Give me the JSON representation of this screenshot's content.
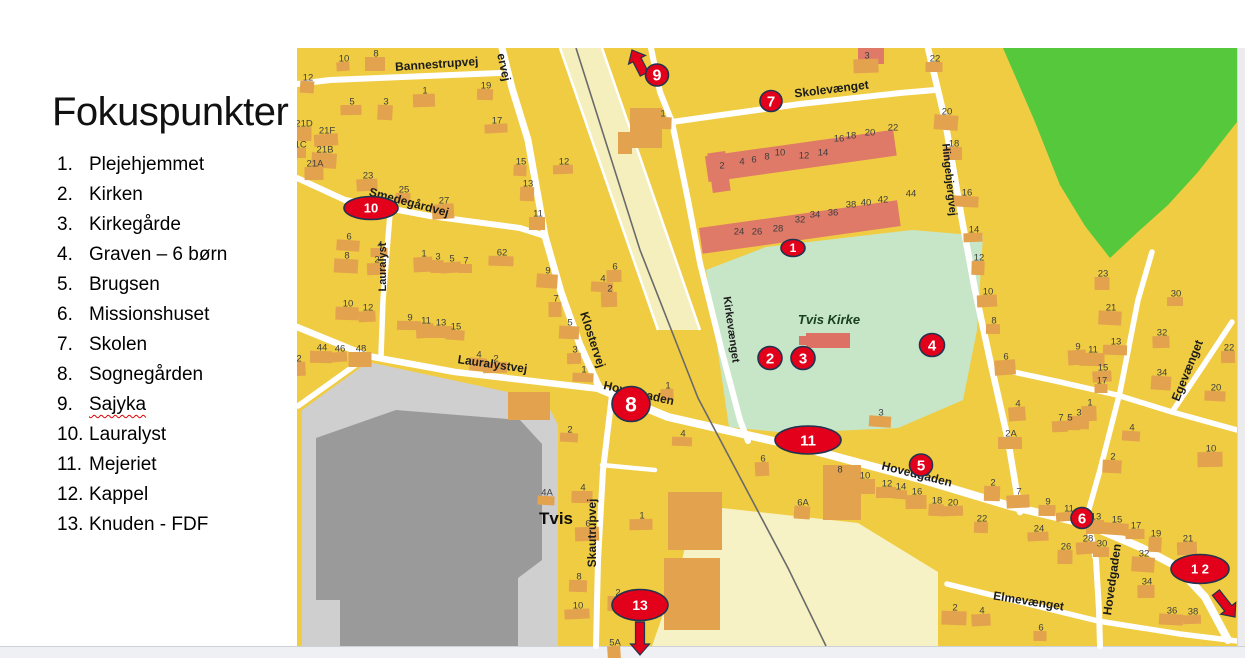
{
  "slide": {
    "title": "Fokuspunkter",
    "items": [
      {
        "num": "1.",
        "label": "Plejehjemmet"
      },
      {
        "num": "2.",
        "label": "Kirken"
      },
      {
        "num": "3.",
        "label": "Kirkegårde"
      },
      {
        "num": "4.",
        "label": "Graven – 6 børn"
      },
      {
        "num": "5.",
        "label": "Brugsen"
      },
      {
        "num": "6.",
        "label": "Missionshuset"
      },
      {
        "num": "7.",
        "label": "Skolen"
      },
      {
        "num": "8.",
        "label": "Sognegården"
      },
      {
        "num": "9.",
        "label": "Sajyka"
      },
      {
        "num": "10.",
        "label": "Lauralyst"
      },
      {
        "num": "11.",
        "label": "Mejeriet"
      },
      {
        "num": "12.",
        "label": "Kappel"
      },
      {
        "num": "13.",
        "label": "Knuden - FDF"
      }
    ]
  },
  "map": {
    "town_label": "Tvis",
    "church_label": "Tvis Kirke",
    "colors": {
      "base": "#F0CC42",
      "building": "#E3A24E",
      "rowhouse": "#DF7A68",
      "park": "#56C83C",
      "churchyard": "#C7E6C8",
      "road": "#ffffff",
      "rail_band": "#F5EFBE",
      "pale_district": "#F7F2C6",
      "factory_lot": "#CFCFCF",
      "factory": "#9A9A9A",
      "marker_fill": "#E2001A",
      "marker_stroke": "#1F3450"
    },
    "street_labels": [
      {
        "t": "Bannestrupvej",
        "x": 437,
        "y": 68,
        "r": -4,
        "s": 12,
        "style": "street"
      },
      {
        "t": "ervej",
        "x": 500,
        "y": 68,
        "r": 78,
        "s": 12,
        "style": "street"
      },
      {
        "t": "Smedegårdvej",
        "x": 408,
        "y": 206,
        "r": 15,
        "s": 12,
        "style": "street"
      },
      {
        "t": "Lauralyst",
        "x": 386,
        "y": 267,
        "r": -90,
        "s": 11,
        "style": "street"
      },
      {
        "t": "Lauralystvej",
        "x": 492,
        "y": 368,
        "r": 8,
        "s": 12,
        "style": "street"
      },
      {
        "t": "Klostervej",
        "x": 589,
        "y": 341,
        "r": 72,
        "s": 12,
        "style": "street"
      },
      {
        "t": "Hovedgaden",
        "x": 638,
        "y": 397,
        "r": 13,
        "s": 12,
        "style": "street"
      },
      {
        "t": "Skolevænget",
        "x": 832,
        "y": 93,
        "r": -7,
        "s": 12,
        "style": "street"
      },
      {
        "t": "Kirkevænget",
        "x": 728,
        "y": 330,
        "r": 82,
        "s": 11,
        "style": "street"
      },
      {
        "t": "Hingebjergvej",
        "x": 946,
        "y": 180,
        "r": 84,
        "s": 11,
        "style": "street"
      },
      {
        "t": "Egevænget",
        "x": 1191,
        "y": 372,
        "r": -68,
        "s": 12,
        "style": "street"
      },
      {
        "t": "Hovedgaden",
        "x": 916,
        "y": 478,
        "r": 14,
        "s": 12,
        "style": "street"
      },
      {
        "t": "Hovedgaden",
        "x": 1116,
        "y": 580,
        "r": -82,
        "s": 12,
        "style": "street"
      },
      {
        "t": "Skautrupvej",
        "x": 596,
        "y": 533,
        "r": -90,
        "s": 12,
        "style": "street"
      },
      {
        "t": "Elmevænget",
        "x": 1028,
        "y": 605,
        "r": 9,
        "s": 12,
        "style": "street"
      },
      {
        "t": "Tvis Kirke",
        "x": 829,
        "y": 324,
        "r": 0,
        "s": 13,
        "style": "church"
      },
      {
        "t": "Tvis",
        "x": 556,
        "y": 524,
        "r": 0,
        "s": 17,
        "style": "town"
      }
    ],
    "house_numbers": [
      [
        "10",
        344,
        58
      ],
      [
        "8",
        376,
        53
      ],
      [
        "12",
        308,
        77
      ],
      [
        "5",
        352,
        101
      ],
      [
        "3",
        386,
        101
      ],
      [
        "1",
        425,
        90
      ],
      [
        "19",
        486,
        85
      ],
      [
        "17",
        497,
        120
      ],
      [
        "21D",
        304,
        123
      ],
      [
        "21F",
        327,
        130
      ],
      [
        "21C",
        298,
        144
      ],
      [
        "21B",
        325,
        149
      ],
      [
        "21A",
        315,
        163
      ],
      [
        "15",
        521,
        161
      ],
      [
        "12",
        564,
        161
      ],
      [
        "13",
        528,
        183
      ],
      [
        "23",
        368,
        175
      ],
      [
        "25",
        404,
        189
      ],
      [
        "27",
        444,
        200
      ],
      [
        "11",
        538,
        213
      ],
      [
        "6",
        349,
        236
      ],
      [
        "4",
        380,
        244
      ],
      [
        "8",
        347,
        255
      ],
      [
        "2",
        377,
        259
      ],
      [
        "62",
        502,
        252
      ],
      [
        "1",
        424,
        253
      ],
      [
        "3",
        438,
        256
      ],
      [
        "5",
        452,
        258
      ],
      [
        "7",
        466,
        260
      ],
      [
        "9",
        548,
        270
      ],
      [
        "6",
        615,
        266
      ],
      [
        "4",
        603,
        278
      ],
      [
        "2",
        610,
        288
      ],
      [
        "10",
        348,
        303
      ],
      [
        "12",
        368,
        307
      ],
      [
        "9",
        410,
        317
      ],
      [
        "11",
        426,
        320
      ],
      [
        "13",
        441,
        322
      ],
      [
        "15",
        456,
        326
      ],
      [
        "7",
        556,
        298
      ],
      [
        "5",
        570,
        322
      ],
      [
        "3",
        575,
        349
      ],
      [
        "1",
        584,
        369
      ],
      [
        "2",
        299,
        358
      ],
      [
        "44",
        322,
        347
      ],
      [
        "46",
        340,
        348
      ],
      [
        "48",
        361,
        348
      ],
      [
        "4",
        479,
        354
      ],
      [
        "2",
        496,
        358
      ],
      [
        "2",
        570,
        429
      ],
      [
        "3",
        867,
        55
      ],
      [
        "1",
        663,
        113
      ],
      [
        "2",
        722,
        165,
        0
      ],
      [
        "4",
        742,
        161,
        0
      ],
      [
        "6",
        754,
        159,
        0
      ],
      [
        "8",
        767,
        156,
        0
      ],
      [
        "10",
        780,
        152,
        0
      ],
      [
        "12",
        804,
        155,
        0
      ],
      [
        "14",
        823,
        152,
        0
      ],
      [
        "16",
        839,
        138,
        0
      ],
      [
        "18",
        851,
        135,
        0
      ],
      [
        "20",
        870,
        132,
        0
      ],
      [
        "22",
        893,
        127,
        0
      ],
      [
        "24",
        739,
        231,
        0
      ],
      [
        "26",
        757,
        231,
        0
      ],
      [
        "28",
        778,
        228,
        0
      ],
      [
        "32",
        800,
        219,
        0
      ],
      [
        "34",
        815,
        214,
        0
      ],
      [
        "36",
        833,
        212,
        0
      ],
      [
        "38",
        851,
        204,
        0
      ],
      [
        "40",
        866,
        202,
        0
      ],
      [
        "42",
        883,
        199,
        0
      ],
      [
        "44",
        911,
        193,
        0
      ],
      [
        "22",
        935,
        58
      ],
      [
        "20",
        947,
        111
      ],
      [
        "18",
        954,
        143
      ],
      [
        "16",
        967,
        192
      ],
      [
        "14",
        974,
        229
      ],
      [
        "12",
        979,
        257
      ],
      [
        "10",
        988,
        291
      ],
      [
        "8",
        994,
        320
      ],
      [
        "6",
        1006,
        356
      ],
      [
        "23",
        1103,
        273
      ],
      [
        "3",
        881,
        412
      ],
      [
        "30",
        1176,
        293
      ],
      [
        "21",
        1111,
        307
      ],
      [
        "32",
        1162,
        332
      ],
      [
        "13",
        1116,
        341
      ],
      [
        "9",
        1078,
        346
      ],
      [
        "11",
        1093,
        349
      ],
      [
        "15",
        1103,
        367
      ],
      [
        "17",
        1102,
        380
      ],
      [
        "34",
        1162,
        372
      ],
      [
        "22",
        1229,
        347
      ],
      [
        "20",
        1216,
        387
      ],
      [
        "1",
        1090,
        402
      ],
      [
        "3",
        1079,
        412
      ],
      [
        "7",
        1061,
        417
      ],
      [
        "5",
        1070,
        417
      ],
      [
        "4",
        1018,
        403
      ],
      [
        "2A",
        1011,
        433
      ],
      [
        "4",
        1132,
        427
      ],
      [
        "10",
        1211,
        448
      ],
      [
        "2",
        1113,
        456
      ],
      [
        "1",
        668,
        385
      ],
      [
        "4",
        683,
        433
      ],
      [
        "6",
        763,
        458
      ],
      [
        "4",
        583,
        487
      ],
      [
        "8",
        840,
        469
      ],
      [
        "10",
        865,
        475
      ],
      [
        "6A",
        803,
        502
      ],
      [
        "1",
        642,
        515
      ],
      [
        "4A",
        547,
        492
      ],
      [
        "6",
        588,
        523
      ],
      [
        "8",
        579,
        576
      ],
      [
        "10",
        578,
        605
      ],
      [
        "2",
        618,
        592
      ],
      [
        "5A",
        615,
        642
      ],
      [
        "12",
        887,
        483
      ],
      [
        "14",
        901,
        486
      ],
      [
        "16",
        917,
        491
      ],
      [
        "18",
        937,
        500
      ],
      [
        "20",
        953,
        502
      ],
      [
        "2",
        993,
        482
      ],
      [
        "7",
        1019,
        491
      ],
      [
        "9",
        1048,
        501
      ],
      [
        "11",
        1069,
        508
      ],
      [
        "13",
        1096,
        516
      ],
      [
        "15",
        1117,
        519
      ],
      [
        "17",
        1136,
        525
      ],
      [
        "19",
        1156,
        533
      ],
      [
        "21",
        1188,
        538
      ],
      [
        "22",
        982,
        518
      ],
      [
        "24",
        1039,
        528
      ],
      [
        "26",
        1066,
        546
      ],
      [
        "28",
        1088,
        538
      ],
      [
        "30",
        1102,
        543
      ],
      [
        "32",
        1144,
        553
      ],
      [
        "34",
        1147,
        581
      ],
      [
        "36",
        1172,
        610
      ],
      [
        "38",
        1193,
        611
      ],
      [
        "2",
        955,
        607
      ],
      [
        "4",
        982,
        610
      ],
      [
        "6",
        1041,
        627
      ]
    ],
    "markers": [
      {
        "t": "1",
        "x": 793,
        "y": 248,
        "rx": 12,
        "ry": 8.5,
        "fs": 12
      },
      {
        "t": "2",
        "x": 770,
        "y": 358,
        "rx": 12,
        "ry": 11.5,
        "fs": 15
      },
      {
        "t": "3",
        "x": 803,
        "y": 358,
        "rx": 12,
        "ry": 11.5,
        "fs": 15
      },
      {
        "t": "4",
        "x": 932,
        "y": 345,
        "rx": 12.5,
        "ry": 11.5,
        "fs": 15
      },
      {
        "t": "5",
        "x": 921,
        "y": 465,
        "rx": 11.5,
        "ry": 11,
        "fs": 15
      },
      {
        "t": "6",
        "x": 1082,
        "y": 518,
        "rx": 11,
        "ry": 10.5,
        "fs": 15
      },
      {
        "t": "7",
        "x": 771,
        "y": 101,
        "rx": 11,
        "ry": 10.5,
        "fs": 15
      },
      {
        "t": "8",
        "x": 631,
        "y": 404,
        "rx": 19,
        "ry": 17.5,
        "fs": 21
      },
      {
        "t": "9",
        "x": 657,
        "y": 75,
        "rx": 11.5,
        "ry": 11,
        "fs": 16,
        "arrow": {
          "tx": 632,
          "ty": 50,
          "ang": -117,
          "len": 27
        }
      },
      {
        "t": "10",
        "x": 371,
        "y": 208,
        "rx": 27,
        "ry": 11.5,
        "fs": 13
      },
      {
        "t": "11",
        "x": 808,
        "y": 440,
        "rx": 33,
        "ry": 14,
        "fs": 15
      },
      {
        "t": "1 2",
        "x": 1200,
        "y": 569,
        "rx": 29,
        "ry": 14.5,
        "fs": 13,
        "arrow": {
          "tx": 1235,
          "ty": 617,
          "ang": 52,
          "len": 31
        }
      },
      {
        "t": "13",
        "x": 640,
        "y": 605,
        "rx": 28,
        "ry": 15.5,
        "fs": 14,
        "arrow": {
          "tx": 640,
          "ty": 655,
          "ang": 90,
          "len": 33
        }
      }
    ]
  }
}
